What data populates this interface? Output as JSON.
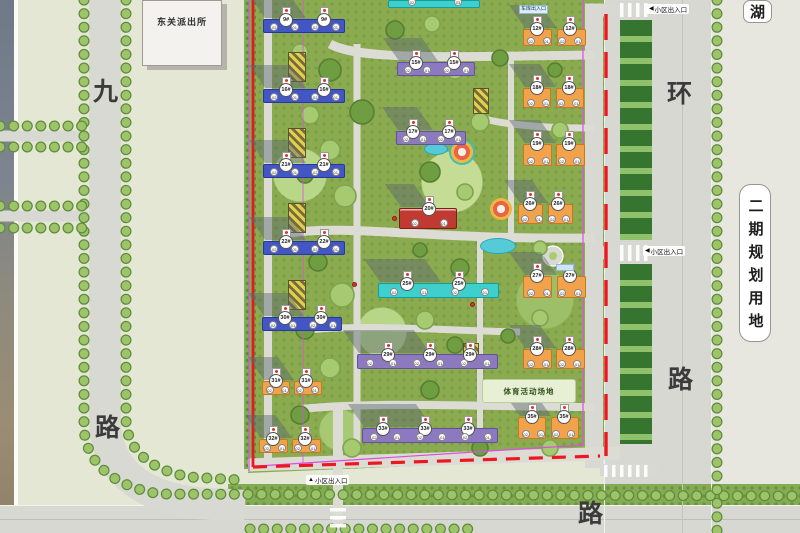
{
  "plan": {
    "police_station": "东关派出所",
    "lake_label": "湖",
    "phase2_label": "二期规划用地",
    "sports_label": "体育活动场地",
    "garage_label": "车库出入口",
    "roads": {
      "west_top": "九",
      "west_bottom": "路",
      "east_top": "环",
      "east_bottom": "路",
      "south": "路"
    },
    "entrances": [
      {
        "arrow": "◀",
        "text": "小区出入口"
      },
      {
        "arrow": "◀",
        "text": "小区出入口"
      },
      {
        "arrow": "▲",
        "text": "小区出入口"
      }
    ],
    "colors": {
      "residential_blue": "#4356c6",
      "residential_purple": "#8d79c0",
      "residential_orange": "#f2a24a",
      "residential_teal": "#3fd0ce",
      "clubhouse_red": "#c03a31",
      "boundary_red": "#ee1620",
      "boundary_magenta": "#d84fe0"
    },
    "buildings": [
      {
        "label": "9#",
        "color": "blue",
        "x": 263,
        "y": 19,
        "w": 82,
        "h": 14,
        "towers": [
          22,
          60
        ]
      },
      {
        "label": "16#",
        "color": "blue",
        "x": 263,
        "y": 89,
        "w": 82,
        "h": 14,
        "towers": [
          22,
          60
        ]
      },
      {
        "label": "21#",
        "color": "blue",
        "x": 263,
        "y": 164,
        "w": 82,
        "h": 14,
        "towers": [
          22,
          60
        ]
      },
      {
        "label": "22#",
        "color": "blue",
        "x": 263,
        "y": 241,
        "w": 82,
        "h": 14,
        "towers": [
          22,
          60
        ]
      },
      {
        "label": "30#",
        "color": "blue",
        "x": 262,
        "y": 317,
        "w": 80,
        "h": 14,
        "towers": [
          22,
          58
        ]
      },
      {
        "label": "31#",
        "color": "orange",
        "x": 262,
        "y": 381,
        "w": 60,
        "h": 14,
        "towers": [
          14,
          44
        ]
      },
      {
        "label": "32#",
        "color": "orange",
        "x": 259,
        "y": 439,
        "w": 62,
        "h": 14,
        "towers": [
          14,
          46
        ]
      },
      {
        "label": "15#",
        "color": "purple",
        "x": 397,
        "y": 62,
        "w": 78,
        "h": 14,
        "towers": [
          18,
          56
        ]
      },
      {
        "label": "17#",
        "color": "purple",
        "x": 396,
        "y": 131,
        "w": 70,
        "h": 14,
        "towers": [
          16,
          52
        ]
      },
      {
        "label": "20#",
        "color": "red",
        "x": 399,
        "y": 208,
        "w": 58,
        "h": 21,
        "towers": [
          29
        ],
        "units": [
          "02",
          "01"
        ]
      },
      {
        "label": "25#",
        "color": "teal",
        "x": 378,
        "y": 283,
        "w": 121,
        "h": 15,
        "towers": [
          28,
          80
        ]
      },
      {
        "label": "29#",
        "color": "purple",
        "x": 357,
        "y": 354,
        "w": 141,
        "h": 15,
        "towers": [
          30,
          72,
          112
        ]
      },
      {
        "label": "33#",
        "color": "purple",
        "x": 362,
        "y": 428,
        "w": 136,
        "h": 15,
        "towers": [
          20,
          62,
          105
        ]
      },
      {
        "label": "12#",
        "color": "orange",
        "x": 523,
        "y": 29,
        "w": 63,
        "h": 17,
        "towers": [
          14,
          47
        ]
      },
      {
        "label": "18#",
        "color": "orange",
        "x": 523,
        "y": 88,
        "w": 61,
        "h": 20,
        "towers": [
          14,
          46
        ]
      },
      {
        "label": "19#",
        "color": "orange",
        "x": 523,
        "y": 144,
        "w": 62,
        "h": 22,
        "towers": [
          14,
          46
        ]
      },
      {
        "label": "26#",
        "color": "orange",
        "x": 518,
        "y": 204,
        "w": 55,
        "h": 20,
        "towers": [
          12,
          40
        ]
      },
      {
        "label": "27#",
        "color": "orange",
        "x": 523,
        "y": 276,
        "w": 63,
        "h": 22,
        "towers": [
          14,
          47
        ]
      },
      {
        "label": "28#",
        "color": "orange",
        "x": 523,
        "y": 349,
        "w": 62,
        "h": 20,
        "towers": [
          14,
          46
        ]
      },
      {
        "label": "35#",
        "color": "orange",
        "x": 518,
        "y": 417,
        "w": 61,
        "h": 22,
        "towers": [
          14,
          46
        ]
      },
      {
        "label": "",
        "color": "teal",
        "x": 388,
        "y": 0,
        "w": 92,
        "h": 8,
        "towers": [],
        "units": [
          "02",
          "03"
        ],
        "shadow": false
      }
    ]
  }
}
